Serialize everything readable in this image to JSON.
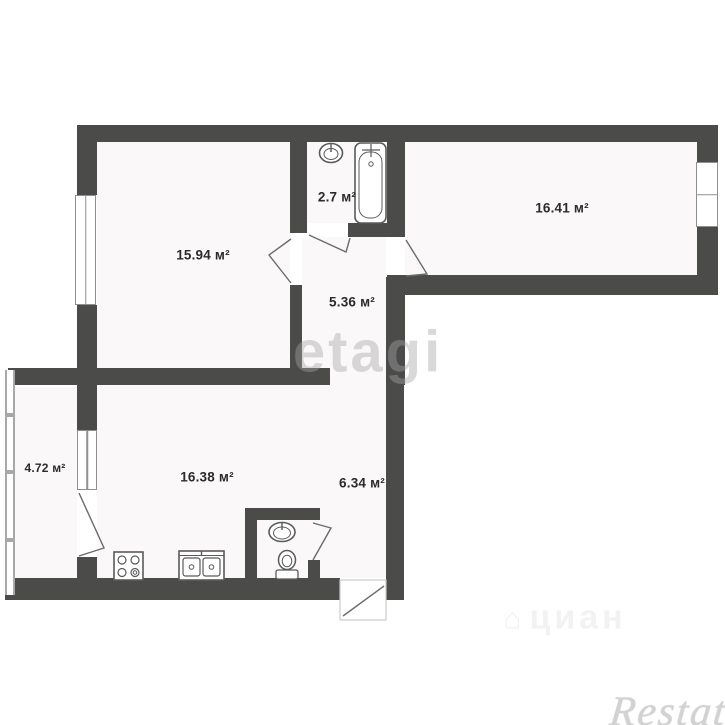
{
  "plan": {
    "rooms": [
      {
        "id": "room-living",
        "area_label": "15.94 м²"
      },
      {
        "id": "bathroom",
        "area_label": "2.7 м²"
      },
      {
        "id": "room-bedroom",
        "area_label": "16.41 м²"
      },
      {
        "id": "hallway-upper",
        "area_label": "5.36 м²"
      },
      {
        "id": "balcony",
        "area_label": "4.72 м²"
      },
      {
        "id": "kitchen",
        "area_label": "16.38 м²"
      },
      {
        "id": "hallway-lower",
        "area_label": "6.34 м²"
      }
    ],
    "fixtures": [
      "bathtub",
      "bathroom-sink",
      "wc-sink",
      "toilet",
      "stove",
      "kitchen-double-sink"
    ],
    "colors": {
      "wall": "#4b4b49",
      "fixture_line": "#5a5a5a",
      "label": "#2b2b2b"
    }
  },
  "watermarks": {
    "etagi": "etagi",
    "cian": "циан",
    "restate": "Restate"
  }
}
